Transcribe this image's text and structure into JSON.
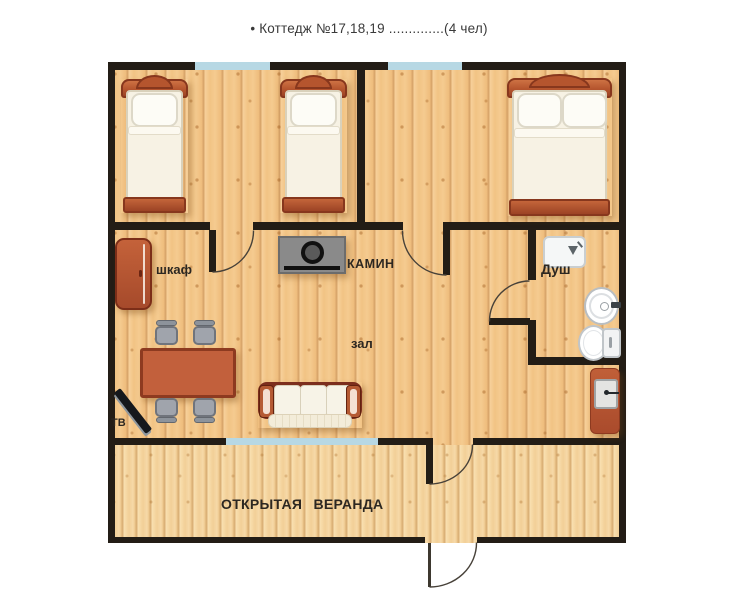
{
  "title": "• Коттедж №17,18,19 ..............(4 чел)",
  "plan": {
    "room_labels": {
      "wardrobe": "шкаф",
      "fireplace": "КАМИН",
      "shower": "Душ",
      "hall": "зал",
      "tv": "ТВ",
      "veranda": "ОТКРЫТАЯ ВЕРАНДА"
    },
    "fixtures": [
      "single-bed",
      "single-bed",
      "double-bed",
      "wardrobe",
      "fireplace",
      "dining-table",
      "chair",
      "chair",
      "chair",
      "chair",
      "sofa",
      "tv",
      "shower-tray",
      "washbasin",
      "toilet",
      "water-heater"
    ],
    "colors": {
      "wall": "#231d16",
      "window": "#b7d8e4",
      "floor_wood": "#f2c788",
      "veranda_wood": "#f4d6a2",
      "furniture_terracotta": "#b5552e",
      "sofa_maroon": "#7c2e1d",
      "chair_gray": "#a0a4ac",
      "fireplace_gray": "#8a8a8a"
    }
  }
}
